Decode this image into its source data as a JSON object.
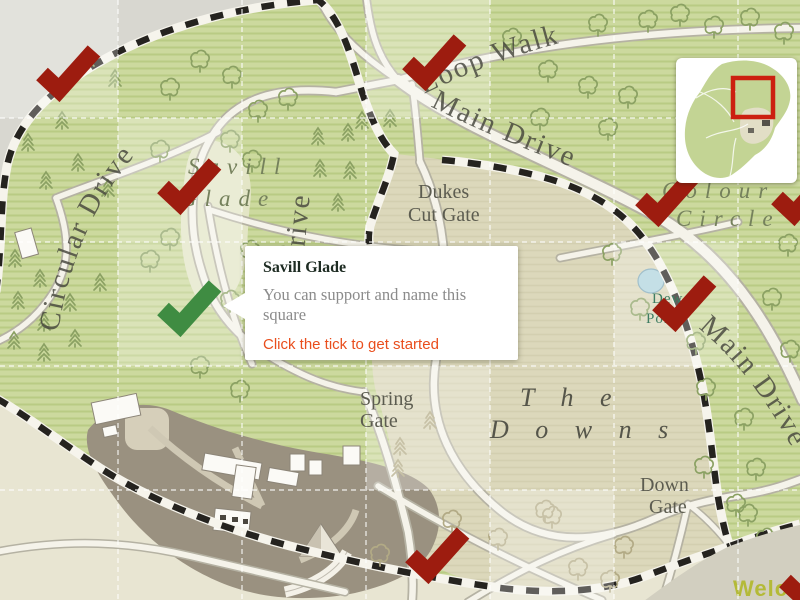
{
  "map_labels": {
    "circular_drive": "Circular Drive",
    "loop_walk": "Loop Walk",
    "main_drive": "Main Drive",
    "main_drive_east": "Main Drive",
    "drive_vertical": "Drive",
    "savill_glade_1": "Savill",
    "savill_glade_2": "Glade",
    "dukes_1": "Dukes",
    "dukes_2": "Cut Gate",
    "colour_1": "Colour",
    "colour_2": "Circle",
    "spring_1": "Spring",
    "spring_2": "Gate",
    "downs_1": "T h e",
    "downs_2": "D o w n s",
    "downgate_1": "Down",
    "downgate_2": "Gate",
    "dew_1": "Dew",
    "dew_2": "Pond",
    "welcome": "Welcome"
  },
  "tooltip": {
    "title": "Savill Glade",
    "body": "You can support and name this square",
    "cta": "Click the tick to get started"
  },
  "ticks": {
    "red_color": "#9d1c0f",
    "green_color": "#3f8c42",
    "items": [
      {
        "x": 67,
        "y": 73,
        "state": "claimed"
      },
      {
        "x": 433,
        "y": 62,
        "state": "claimed"
      },
      {
        "x": 188,
        "y": 186,
        "state": "claimed"
      },
      {
        "x": 666,
        "y": 198,
        "state": "claimed"
      },
      {
        "x": 802,
        "y": 197,
        "state": "claimed"
      },
      {
        "x": 683,
        "y": 303,
        "state": "claimed"
      },
      {
        "x": 188,
        "y": 308,
        "state": "selected"
      },
      {
        "x": 436,
        "y": 555,
        "state": "claimed"
      },
      {
        "x": 810,
        "y": 580,
        "state": "claimed"
      }
    ]
  },
  "minimap": {
    "viewport_color": "#cc2010"
  },
  "colors": {
    "cta_orange": "#e94e1d",
    "park_green": "#ccd99e",
    "downs_beige": "#dcd8bb"
  }
}
